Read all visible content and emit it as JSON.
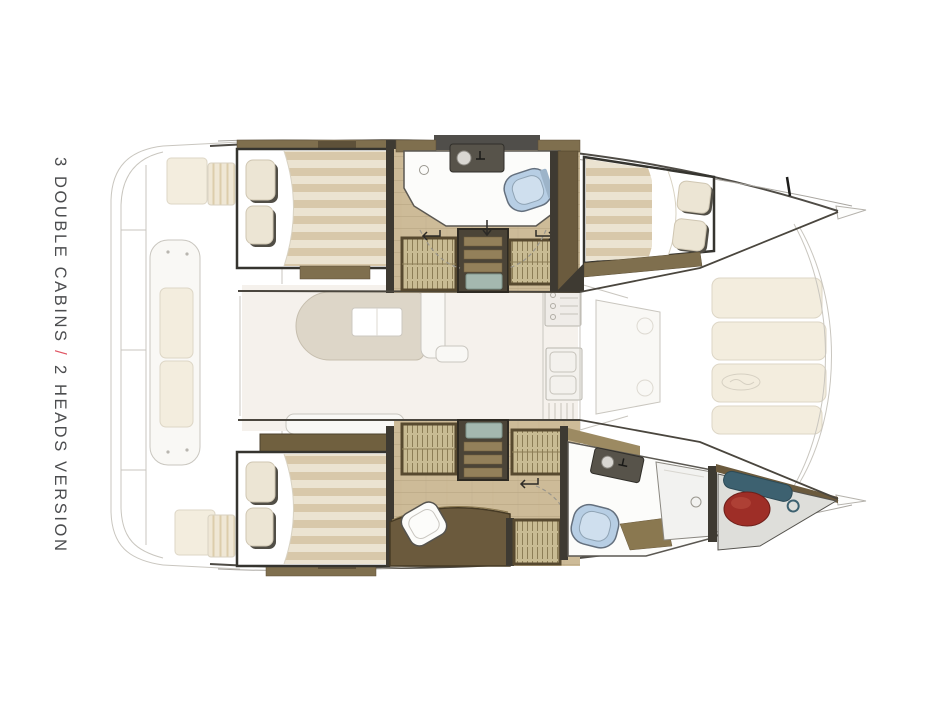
{
  "caption": {
    "part_cabins": "3 DOUBLE CABINS",
    "separator": " / ",
    "part_heads": "2 HEADS VERSION"
  },
  "palette": {
    "page_bg": "#ffffff",
    "caption_text": "#4b4c4e",
    "caption_separator": "#e05664",
    "ghost_line": "#c9c6bf",
    "ghost_fill": "#f9f8f5",
    "outline_dark": "#4f4c46",
    "wood_floor": "#cdbb98",
    "wood_line": "#b6a37f",
    "mattress_cream": "#ebe3d1",
    "mattress_stripe": "#d8c8aa",
    "pillow": "#ece5d4",
    "frame_dark": "#35342f",
    "shelf_brown": "#7f6f4e",
    "cabinet_dark": "#5e5139",
    "wardrobe_fill": "#c8bb93",
    "wardrobe_line": "#8d7e57",
    "step_mat_teal": "#a4b8af",
    "toilet_blue": "#b7cee4",
    "head_floor": "#fcfcfa",
    "fender_red": "#9e2e27",
    "gear_teal": "#3d6170"
  }
}
